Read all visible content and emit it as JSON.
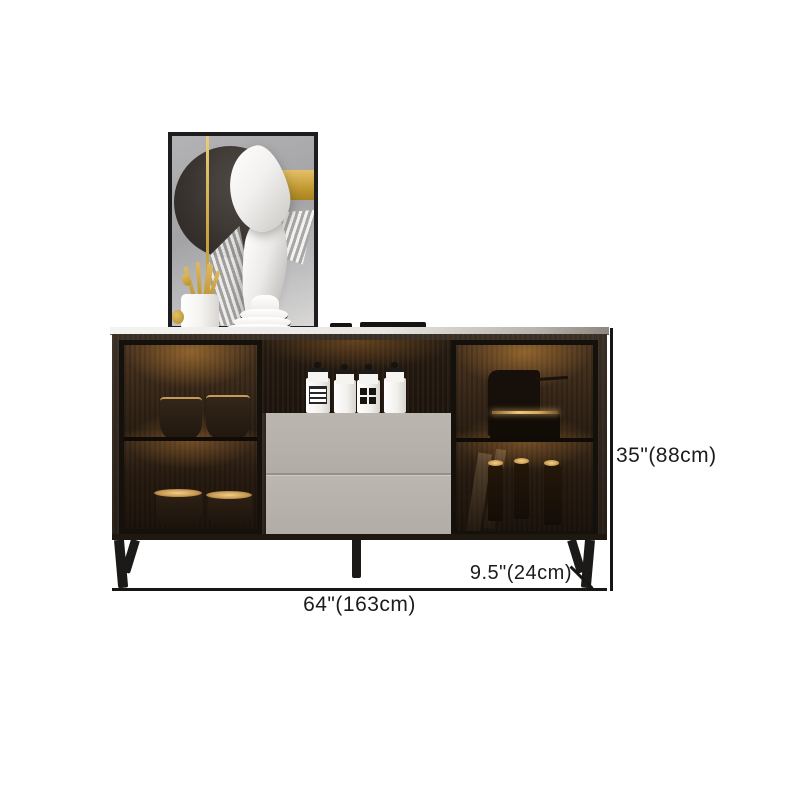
{
  "product": {
    "name": "modern sideboard cabinet with glass doors",
    "decor_items": [
      "wall-art",
      "utensil-holder",
      "plate-stack",
      "canister-jars",
      "wine-bottles",
      "bowls"
    ]
  },
  "dimensions": {
    "width_label": "64\"(163cm)",
    "height_label": "35\"(88cm)",
    "depth_label": "9.5\"(24cm)"
  },
  "colors": {
    "background": "#ffffff",
    "annotation_line": "#161616",
    "annotation_text": "#1c1c1c",
    "cabinet_wood": "#30261d",
    "drawer_front": "#b6b0ab",
    "interior_glow": "#d8943e",
    "accent_gold": "#c9a23f",
    "leg_black": "#1b1a19"
  }
}
